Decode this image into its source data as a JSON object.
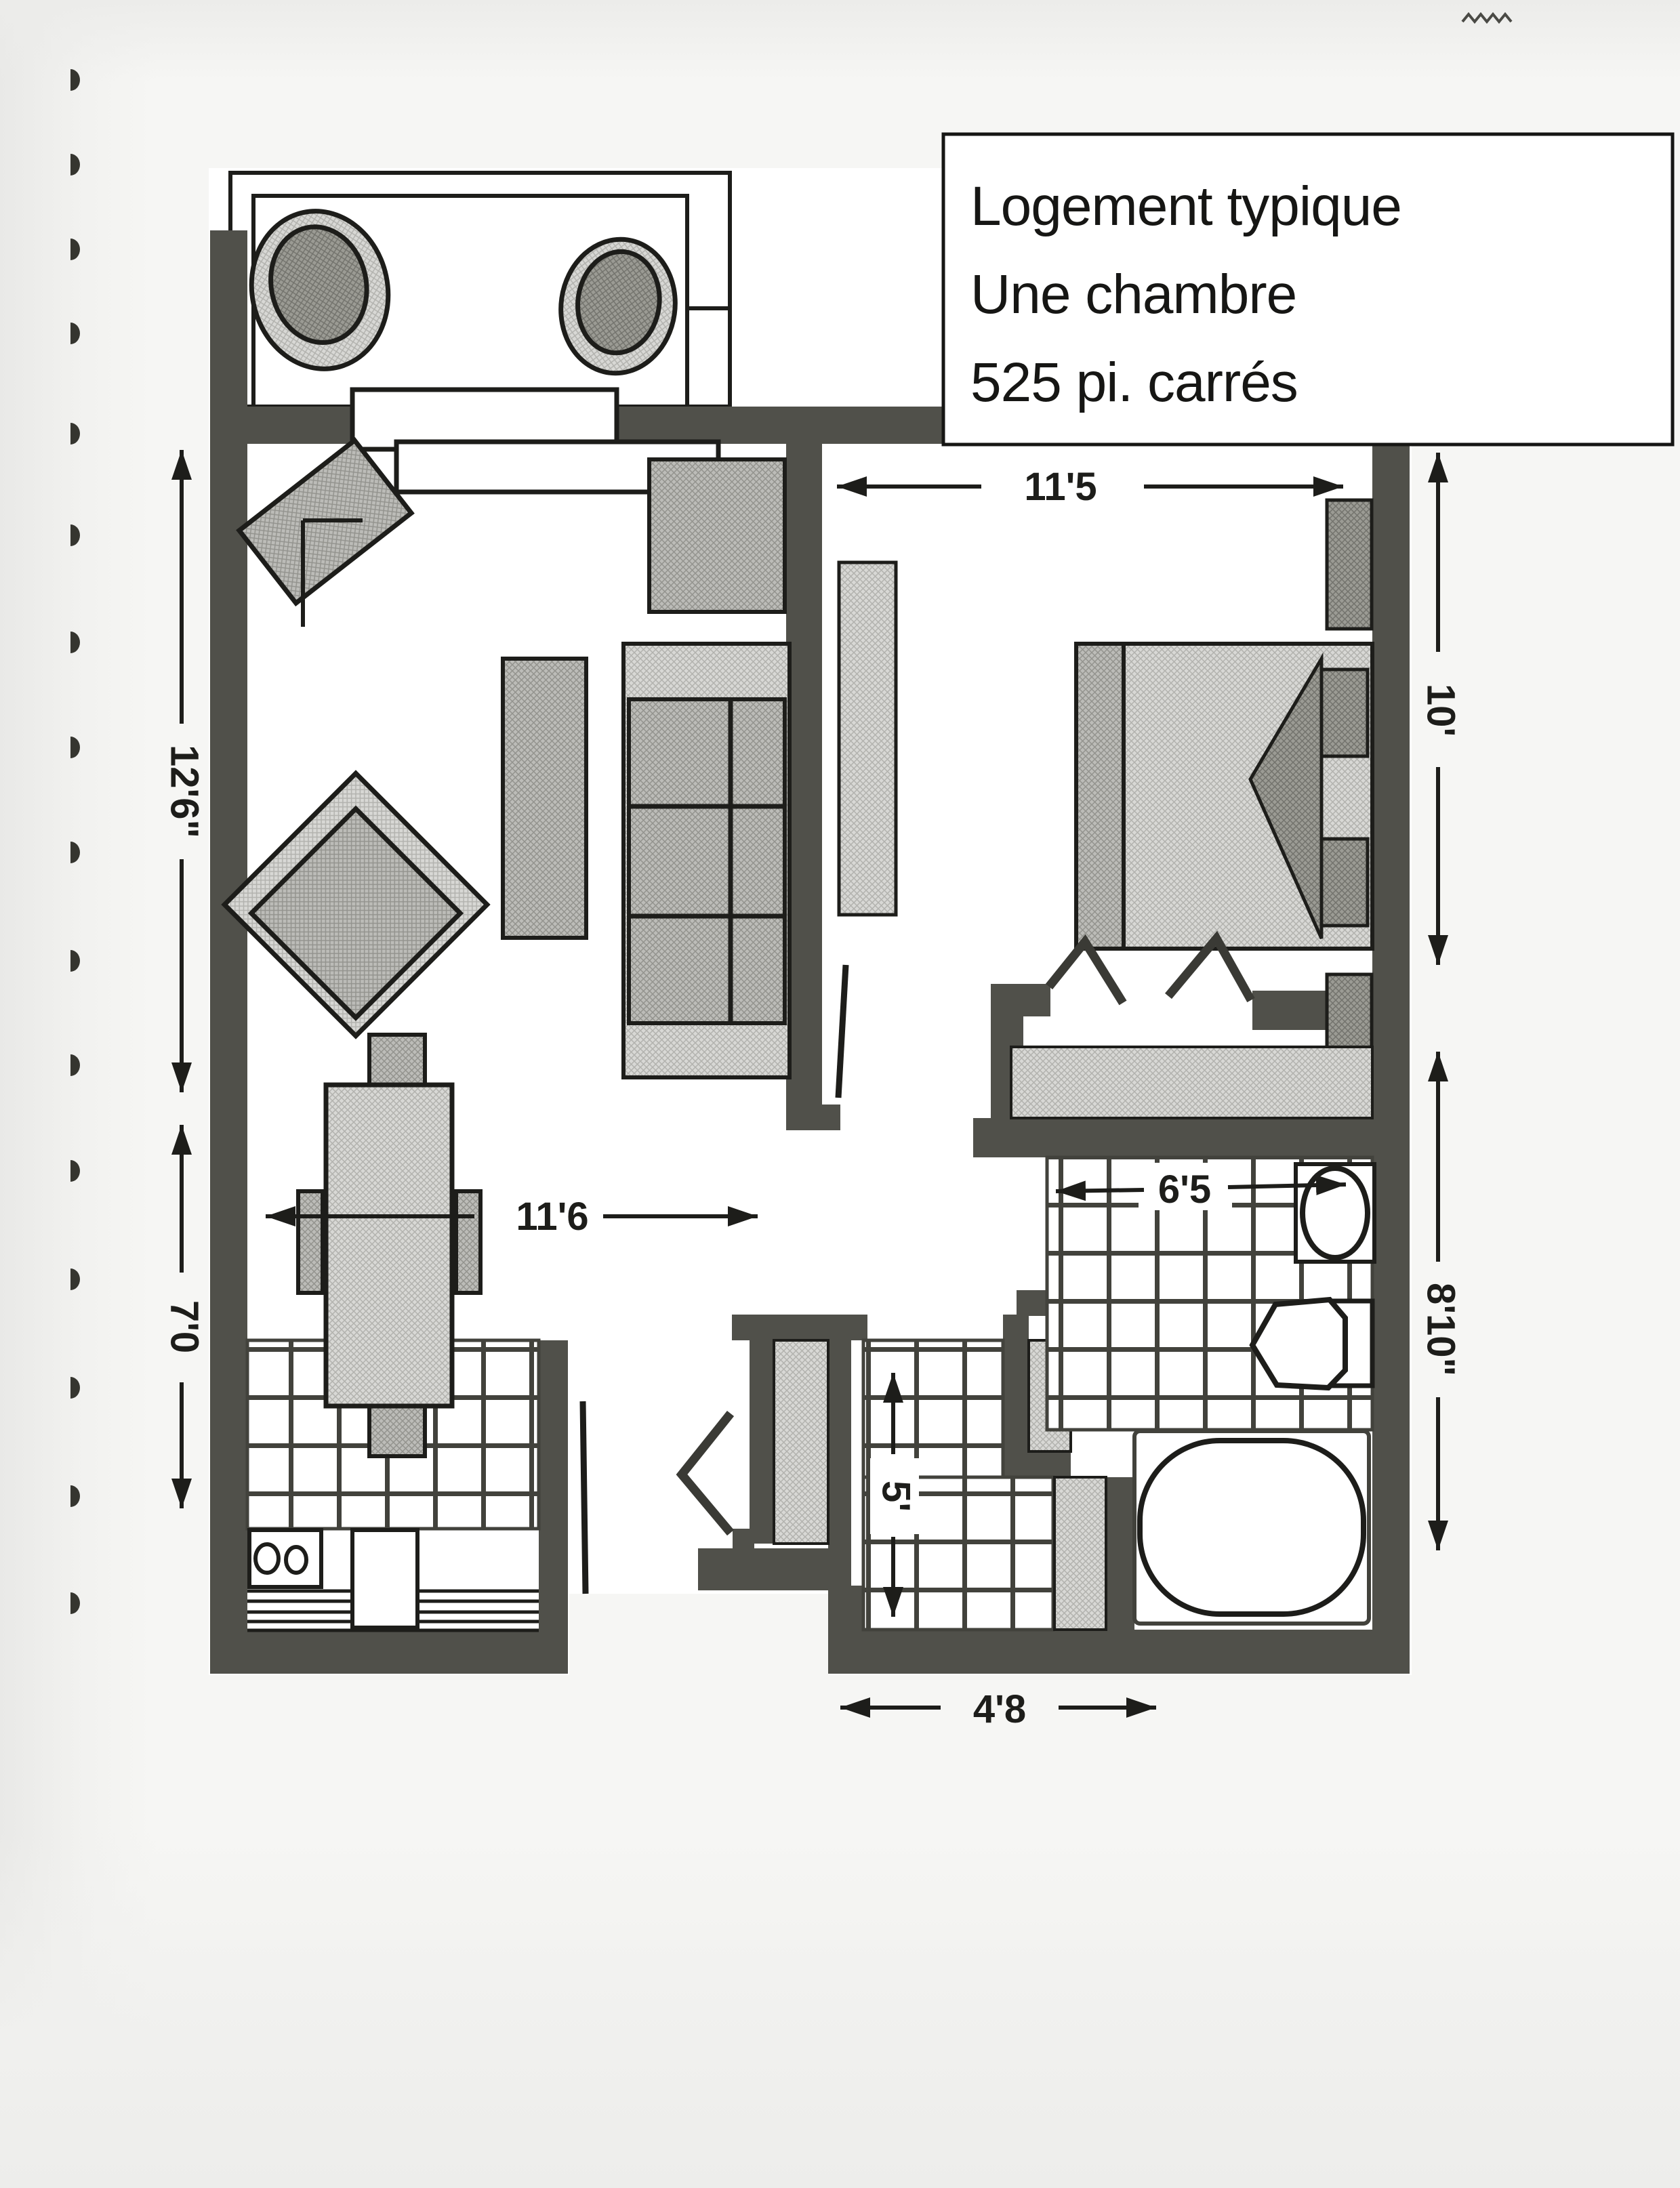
{
  "document": {
    "kind": "scanned floor plan page",
    "title_box": {
      "line1": "Logement typique",
      "line2": "Une chambre",
      "line3": "525 pi. carrés"
    },
    "dims": {
      "living_height": "12'6\"",
      "kitchen_height": "7'0",
      "living_width": "11'6",
      "bedroom_width": "11'5",
      "bedroom_height": "10'",
      "bathroom_width": "6'5",
      "bathroom_height": "8'10\"",
      "entry_height": "5'",
      "entry_width": "4'8"
    },
    "colors": {
      "wall": "#50504a",
      "ink": "#1d1d1a",
      "paper": "#f6f6f4",
      "floor": "#ffffff",
      "hatch_light": "#d8d8d5",
      "hatch_mid": "#bcbcb8",
      "hatch_dark": "#9b9b94",
      "tile_line": "#42423c"
    }
  }
}
